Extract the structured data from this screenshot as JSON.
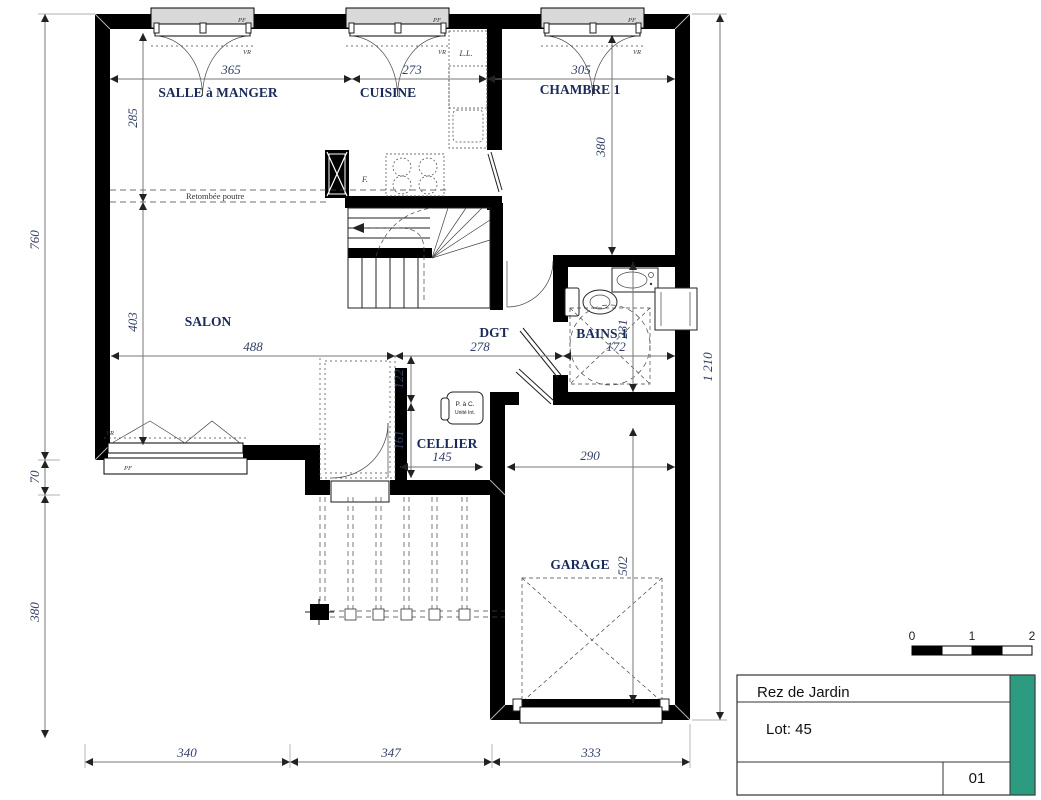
{
  "plan": {
    "rooms": {
      "salle_a_manger": "SALLE à MANGER",
      "cuisine": "CUISINE",
      "chambre1": "CHAMBRE 1",
      "salon": "SALON",
      "dgt": "DGT",
      "bains1": "BAINS 1",
      "cellier": "CELLIER",
      "garage": "GARAGE"
    },
    "dims": {
      "t365": "365",
      "t273": "273",
      "t305": "305",
      "v285": "285",
      "v403": "403",
      "v760": "760",
      "v70": "70",
      "v380_left": "380",
      "v380_chambre": "380",
      "h488": "488",
      "h278": "278",
      "h172": "172",
      "v231": "231",
      "v122": "122",
      "v161": "161",
      "h145": "145",
      "h290": "290",
      "v502": "502",
      "v1210": "1 210",
      "b340": "340",
      "b347": "347",
      "b333": "333"
    },
    "annotations": {
      "beam": "Retombée poutre",
      "pac1": "P. à C.",
      "pac2": "Unité Int.",
      "fridge": "F.",
      "washer": "L.L.",
      "pf": "PF",
      "vr": "VR"
    }
  },
  "title_block": {
    "title": "Rez de Jardin",
    "lot": "Lot: 45",
    "sheet": "01"
  },
  "scale_bar": {
    "n0": "0",
    "n1": "1",
    "n2": "2"
  },
  "colors": {
    "accent": "#2D9B7F",
    "wall": "#000000",
    "room_text": "#1a2a5a",
    "dim_text": "#333f66"
  }
}
